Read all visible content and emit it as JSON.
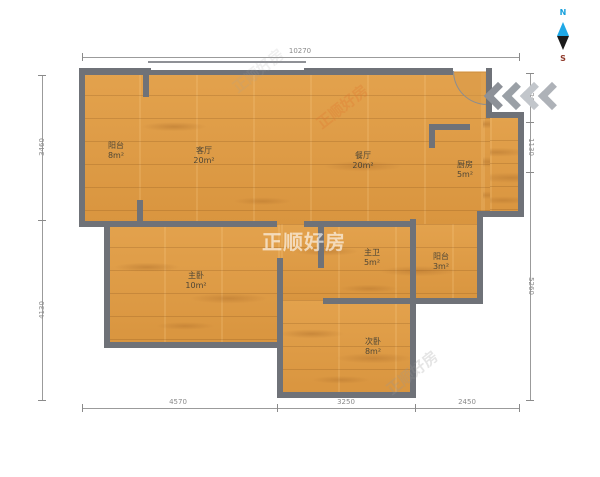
{
  "compass": {
    "north": "N",
    "south": "S"
  },
  "watermark": {
    "brand": "正顺好房"
  },
  "rooms": [
    {
      "name": "阳台",
      "area": "8m²"
    },
    {
      "name": "客厅",
      "area": "20m²"
    },
    {
      "name": "餐厅",
      "area": "20m²"
    },
    {
      "name": "厨房",
      "area": "5m²"
    },
    {
      "name": "主卧",
      "area": "10m²"
    },
    {
      "name": "主卫",
      "area": "5m²"
    },
    {
      "name": "阳台",
      "area": "3m²"
    },
    {
      "name": "次卧",
      "area": "8m²"
    }
  ],
  "dimensions": {
    "top": [
      "10270"
    ],
    "left": [
      "3460",
      "4130"
    ],
    "right": [
      "1260",
      "1130",
      "5260"
    ],
    "bottom": [
      "4570",
      "3250",
      "2450"
    ]
  },
  "colors": {
    "floor": "#DE9C46",
    "wall": "#6F7278",
    "dimension": "#8A8A8A",
    "compass_north": "#18A0DC",
    "compass_south": "#8E3A2B",
    "watermark_orange": "#E07A30"
  }
}
